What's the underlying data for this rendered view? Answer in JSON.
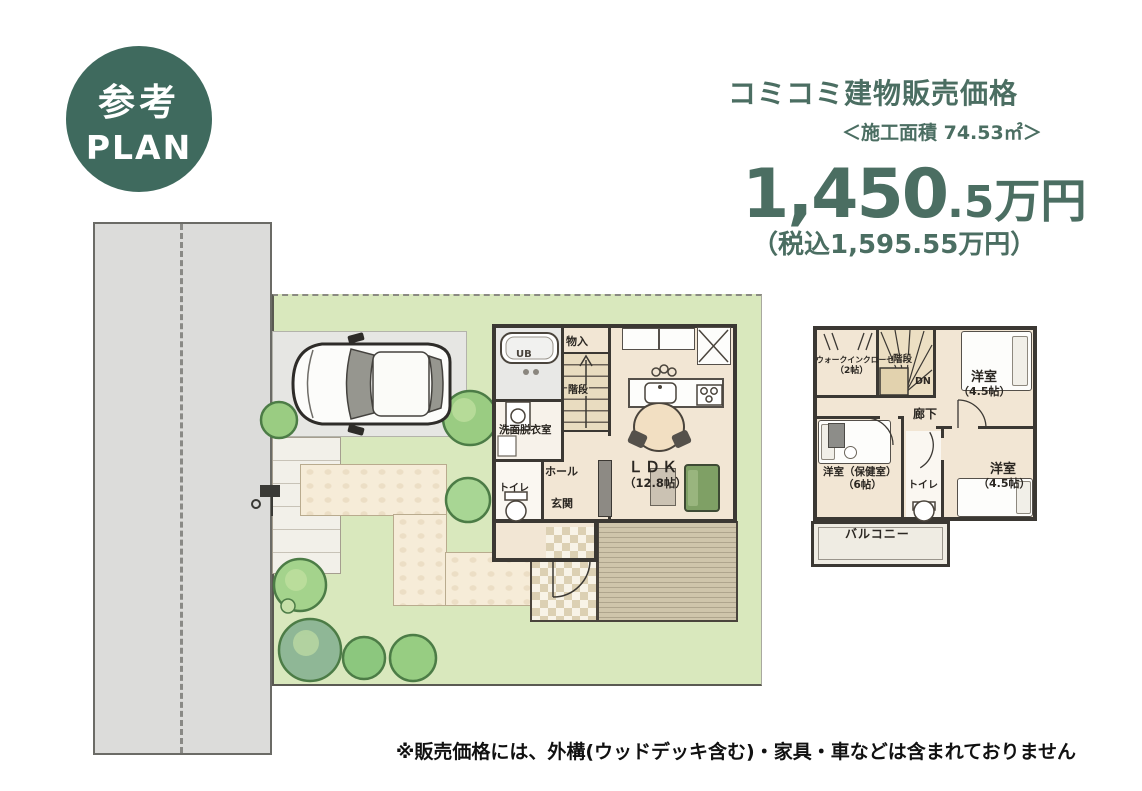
{
  "badge": {
    "line1": "参考",
    "line2": "PLAN"
  },
  "pricing": {
    "title": "コミコミ建物販売価格",
    "area_note": "＜施工面積 74.53㎡＞",
    "price_main": "1,450",
    "price_decimal": ".5",
    "price_unit": "万円",
    "tax_note": "（税込1,595.55万円）"
  },
  "floor1": {
    "rooms": {
      "ub": "UB",
      "mono_ire": "物入",
      "kaidan": "階段",
      "senmen": "洗面脱衣室",
      "toilet": "トイレ",
      "hall": "ホール",
      "genkan": "玄関",
      "ldk": "ＬＤＫ",
      "ldk_size": "（12.8帖）"
    }
  },
  "floor2": {
    "rooms": {
      "wic": "ウォークインクローゼット",
      "wic_size": "（2帖）",
      "kaidan": "階段",
      "dn": "DN",
      "bedroom_tr": "洋室",
      "bedroom_tr_size": "（4.5帖）",
      "rouka": "廊下",
      "bedroom_bl": "洋室（保健室）",
      "bedroom_bl_size": "（6帖）",
      "toilet": "トイレ",
      "bedroom_br": "洋室",
      "bedroom_br_size": "（4.5帖）",
      "balcony": "バルコニー"
    }
  },
  "disclaimer": "※販売価格には、外構(ウッドデッキ含む)・家具・車などは含まれておりません",
  "colors": {
    "accent_teal": "#4B6E62",
    "badge_green": "#3F6A5E",
    "lawn_green": "#D9E8BD",
    "road_gray": "#DCDCDA",
    "floor_beige": "#F2E6D4",
    "wall_dark": "#3B3833",
    "deck_tan": "#CFC5AB"
  }
}
